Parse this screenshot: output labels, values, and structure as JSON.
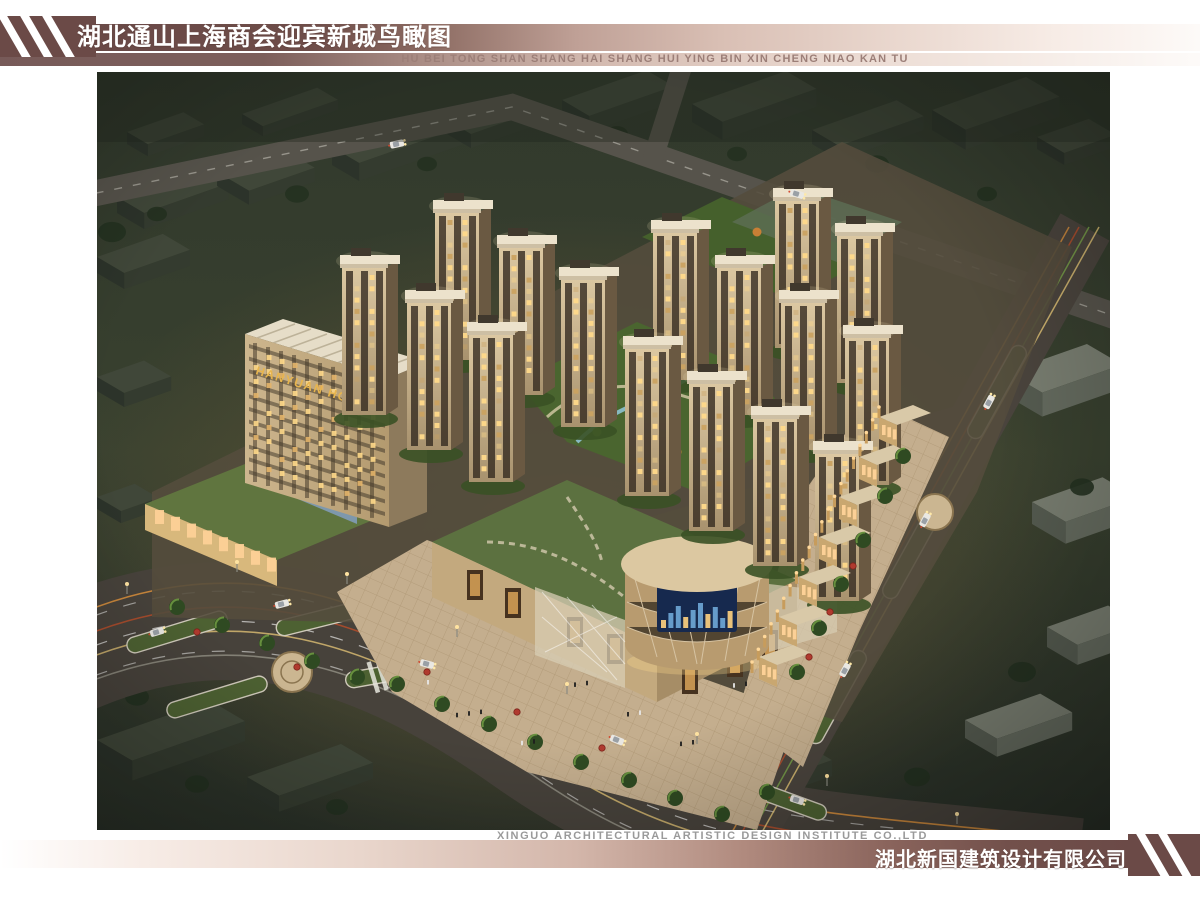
{
  "header": {
    "title_cn": "湖北通山上海商会迎宾新城鸟瞰图",
    "title_pinyin": "HU BEI TONG SHAN SHANG HAI SHANG HUI YING BIN XIN CHENG NIAO KAN TU"
  },
  "rendering": {
    "hotel_sign": "HANYUAN HOTEL"
  },
  "footer": {
    "designer_en": "XINGUO ARCHITECTURAL ARTISTIC DESIGN INSTITUTE CO.,LTD",
    "designer_cn": "湖北新国建筑设计有限公司"
  },
  "colors": {
    "accent_maroon": "#6b4a47",
    "band_light": "#f3e9e3",
    "pinyin_text": "#9c7f78",
    "footer_en_text": "#9a9a9a",
    "hotel_sign_gold": "#e7b54e",
    "night_ground": "#333b2d",
    "lawn_green": "#5c7140",
    "building_tan": "#c9b38f"
  }
}
